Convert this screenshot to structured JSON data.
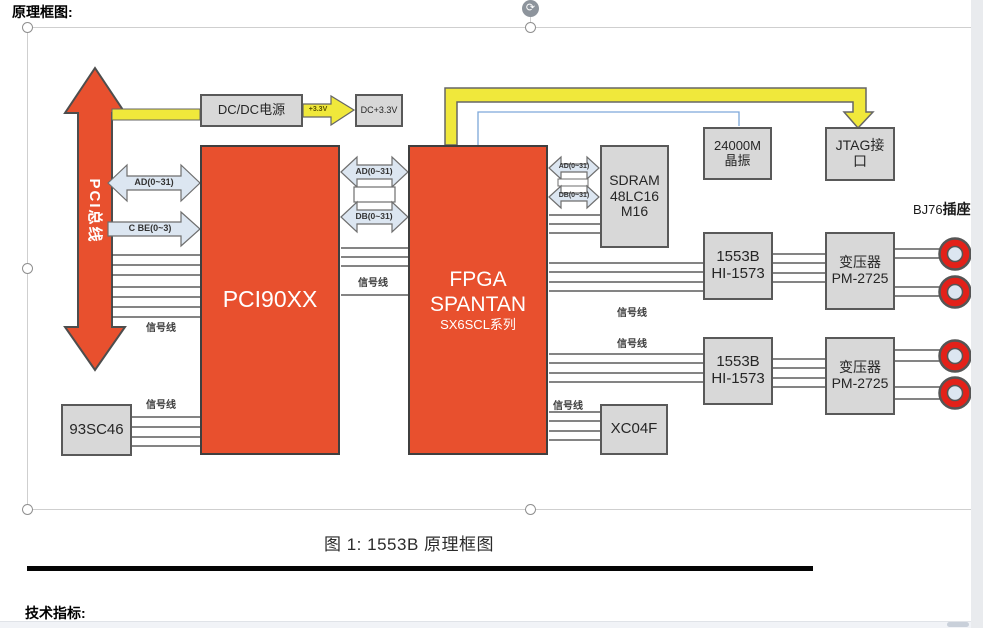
{
  "page": {
    "top_heading": "原理框图:",
    "caption": "图 1: 1553B 原理框图",
    "bottom_heading": "技术指标:"
  },
  "colors": {
    "block_orange": "#E8502E",
    "box_gray": "#D8D8D8",
    "wire_yellow": "#F0E83B",
    "arrow_blue_fill": "#DCE6F1",
    "connector_red": "#E32119",
    "clock_line_blue": "#7DA7D9"
  },
  "blocks": {
    "pci_bus": "PCI总线",
    "dcdc_power": "DC/DC电源",
    "dc_33v": "DC+3.3V",
    "pci90xx": "PCI90XX",
    "fpga": [
      "FPGA",
      "SPANTAN",
      "SX6SCL系列"
    ],
    "sdram": [
      "SDRAM",
      "48LC16",
      "M16"
    ],
    "crystal": [
      "24000M",
      "晶振"
    ],
    "jtag": [
      "JTAG接",
      "口"
    ],
    "b1553_1": [
      "1553B",
      "HI-1573"
    ],
    "b1553_2": [
      "1553B",
      "HI-1573"
    ],
    "transformer_1": [
      "变压器",
      "PM-2725"
    ],
    "transformer_2": [
      "变压器",
      "PM-2725"
    ],
    "eeprom": "93SC46",
    "xc04f": "XC04F"
  },
  "wire_labels": {
    "ad_bus": "AD(0~31)",
    "cbe_bus": "C BE(0~3)",
    "db_bus": "DB(0~31)",
    "signal": "信号线",
    "v33": "+3.3V",
    "connector": {
      "prefix": "BJ76",
      "suffix": "插座"
    }
  },
  "icons": {
    "rotate_glyph": "⟳"
  }
}
